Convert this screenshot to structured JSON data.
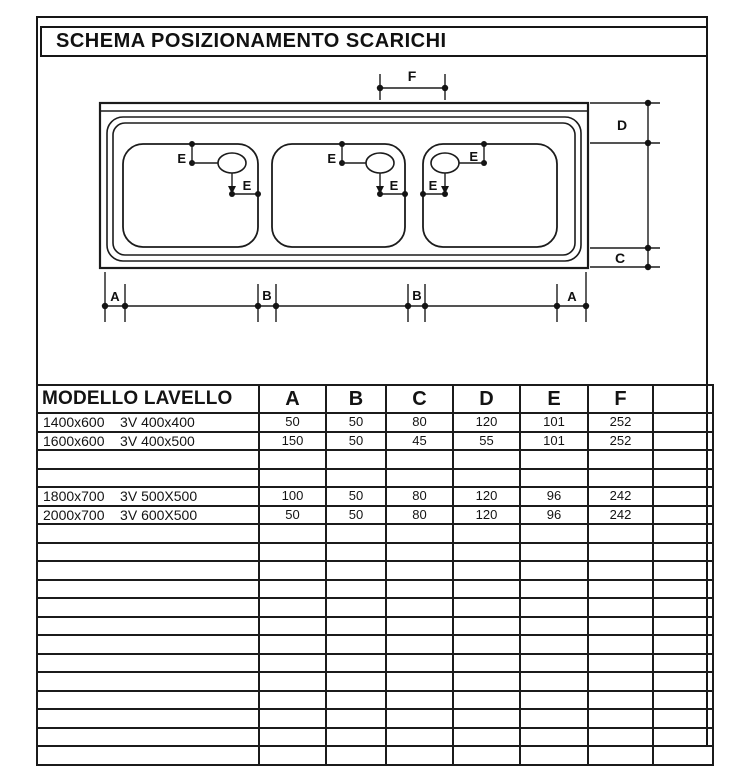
{
  "page": {
    "title": "SCHEMA POSIZIONAMENTO SCARICHI"
  },
  "drawing": {
    "labels": {
      "a": "A",
      "b": "B",
      "c": "C",
      "d": "D",
      "e": "E",
      "f": "F"
    }
  },
  "table": {
    "header": {
      "model": "MODELLO LAVELLO",
      "cols": [
        "A",
        "B",
        "C",
        "D",
        "E",
        "F"
      ],
      "extra": ""
    },
    "rows": [
      {
        "model": "1400x600    3V 400x400",
        "values": [
          "50",
          "50",
          "80",
          "120",
          "101",
          "252"
        ]
      },
      {
        "model": "1600x600    3V 400x500",
        "values": [
          "150",
          "50",
          "45",
          "55",
          "101",
          "252"
        ]
      },
      {
        "model": "",
        "values": [
          "",
          "",
          "",
          "",
          "",
          ""
        ]
      },
      {
        "model": "",
        "values": [
          "",
          "",
          "",
          "",
          "",
          ""
        ]
      },
      {
        "model": "1800x700    3V 500X500",
        "values": [
          "100",
          "50",
          "80",
          "120",
          "96",
          "242"
        ]
      },
      {
        "model": "2000x700    3V 600X500",
        "values": [
          "50",
          "50",
          "80",
          "120",
          "96",
          "242"
        ]
      },
      {
        "model": "",
        "values": [
          "",
          "",
          "",
          "",
          "",
          ""
        ]
      },
      {
        "model": "",
        "values": [
          "",
          "",
          "",
          "",
          "",
          ""
        ]
      },
      {
        "model": "",
        "values": [
          "",
          "",
          "",
          "",
          "",
          ""
        ]
      },
      {
        "model": "",
        "values": [
          "",
          "",
          "",
          "",
          "",
          ""
        ]
      },
      {
        "model": "",
        "values": [
          "",
          "",
          "",
          "",
          "",
          ""
        ]
      },
      {
        "model": "",
        "values": [
          "",
          "",
          "",
          "",
          "",
          ""
        ]
      },
      {
        "model": "",
        "values": [
          "",
          "",
          "",
          "",
          "",
          ""
        ]
      },
      {
        "model": "",
        "values": [
          "",
          "",
          "",
          "",
          "",
          ""
        ]
      },
      {
        "model": "",
        "values": [
          "",
          "",
          "",
          "",
          "",
          ""
        ]
      },
      {
        "model": "",
        "values": [
          "",
          "",
          "",
          "",
          "",
          ""
        ]
      },
      {
        "model": "",
        "values": [
          "",
          "",
          "",
          "",
          "",
          ""
        ]
      },
      {
        "model": "",
        "values": [
          "",
          "",
          "",
          "",
          "",
          ""
        ]
      },
      {
        "model": "",
        "values": [
          "",
          "",
          "",
          "",
          "",
          ""
        ]
      }
    ]
  }
}
